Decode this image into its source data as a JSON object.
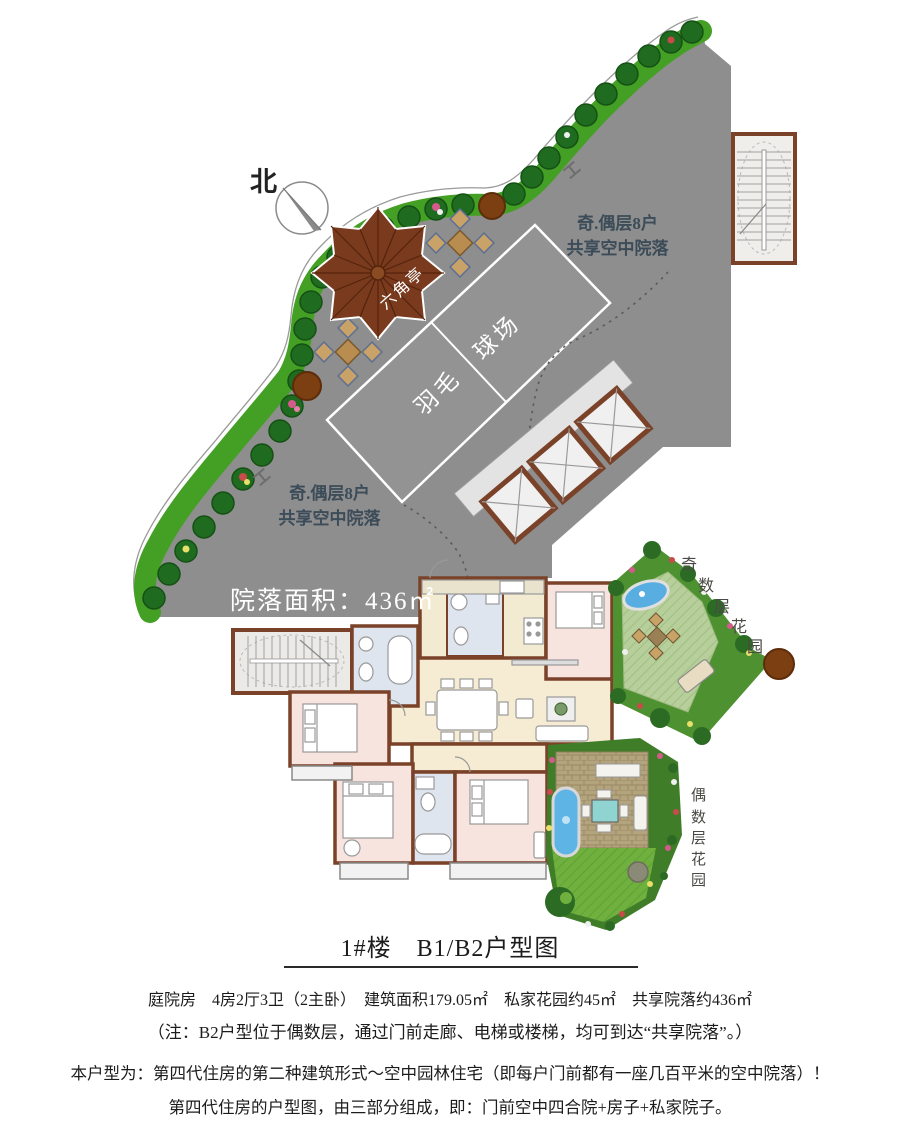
{
  "north_label": "北",
  "pavilion_label": "六角亭",
  "court_label": "羽毛　球场",
  "courtyard_note_top": {
    "line1": "奇.偶层8户",
    "line2": "共享空中院落"
  },
  "courtyard_note_bottom": {
    "line1": "奇.偶层8户",
    "line2": "共享空中院落"
  },
  "area_label": "院落面积：436㎡",
  "garden_odd": {
    "name": "奇数层花园",
    "chars": [
      "奇",
      "数",
      "层",
      "花",
      "园"
    ]
  },
  "garden_even": {
    "name": "偶数层花园",
    "chars": [
      "偶",
      "数",
      "层",
      "花",
      "园"
    ]
  },
  "title": "1#楼　B1/B2户型图",
  "specs_line": "庭院房　4房2厅3卫（2主卧）　建筑面积179.05㎡　私家花园约45㎡　共享院落约436㎡",
  "note_line": "（注：B2户型位于偶数层，通过门前走廊、电梯或楼梯，均可到达“共享院落”。）",
  "desc_line1": "本户型为：第四代住房的第二种建筑形式～空中园林住宅（即每户门前都有一座几百平米的空中院落）！",
  "desc_line2": "第四代住房的户型图，由三部分组成，即：门前空中四合院+房子+私家院子。",
  "colors": {
    "platform_gray": "#8e8e8e",
    "wall_brown": "#7a4228",
    "pavilion_brown": "#7a3a1d",
    "strip_green": "#44a025",
    "tree_green": "#1f6b1f",
    "lawn_light": "#b7cf9a",
    "lawn_dark": "#6fb03f",
    "pond_blue": "#58aee0",
    "room_beige": "#f6ecd4",
    "room_pink": "#f8e4de",
    "bath_blue": "#dfe5ef"
  }
}
